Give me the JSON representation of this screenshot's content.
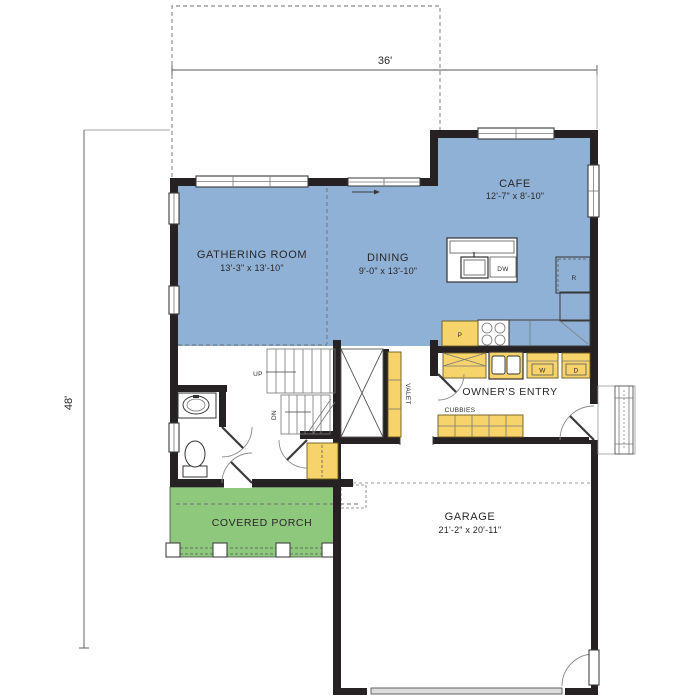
{
  "title": "First floor plan",
  "colors": {
    "room_blue": "#8fb1d6",
    "porch_green": "#8dc87d",
    "cabinet_yellow": "#f6d46b",
    "wall_dark": "#262223"
  },
  "dimensions": {
    "overall_width": "36'",
    "overall_depth": "48'"
  },
  "rooms": {
    "gathering": {
      "name": "GATHERING ROOM",
      "size": "13'-3\" x 13'-10\""
    },
    "dining": {
      "name": "DINING",
      "size": "9'-0\" x 13'-10\""
    },
    "cafe": {
      "name": "CAFE",
      "size": "12'-7\" x 8'-10\""
    },
    "owners_entry": {
      "name": "OWNER'S ENTRY"
    },
    "garage": {
      "name": "GARAGE",
      "size": "21'-2\" x 20'-11\""
    },
    "covered_porch": {
      "name": "COVERED PORCH"
    }
  },
  "fixtures": {
    "dishwasher": "DW",
    "refrigerator": "R",
    "pantry": "P",
    "washer": "W",
    "dryer": "D",
    "cubbies": "CUBBIES",
    "valet": "VALET",
    "stair_up": "UP",
    "stair_down": "DN"
  }
}
